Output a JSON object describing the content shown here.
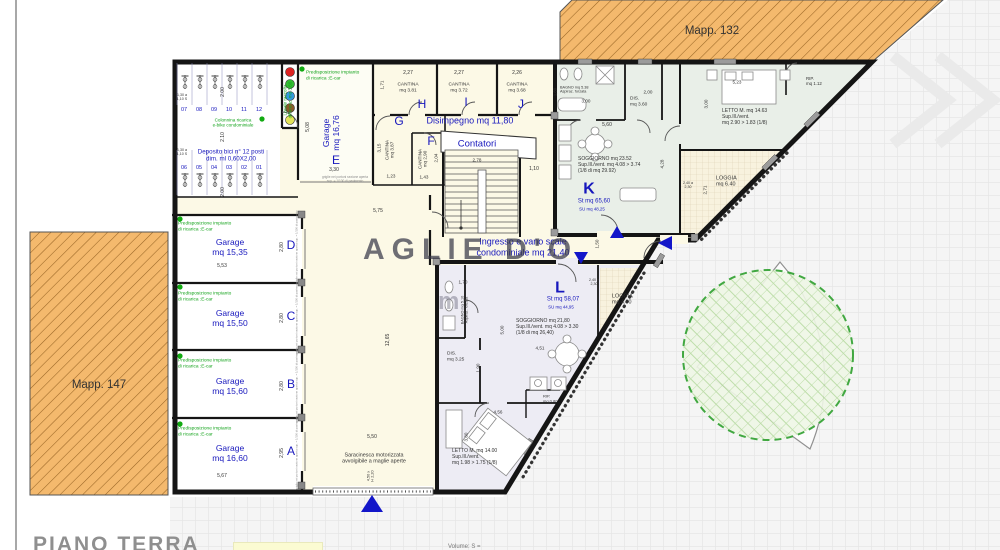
{
  "sheet": {
    "title": "PIANO TERRA",
    "legend_note": "Volume: S ="
  },
  "watermark": {
    "text": "AGLIE D'O",
    "text2": "m"
  },
  "palette": {
    "blue": "#1717bd",
    "green": "#14a31c",
    "dark": "#333333",
    "gray": "#8c8c8c",
    "orange": "#f4b96d",
    "tree_green": "#2ea02e",
    "wall": "#151515",
    "marker_blue": "#1316c9"
  },
  "labels": [
    {
      "n": "mapp-132-label",
      "t": "Mapp. 132",
      "x": 712,
      "y": 32,
      "s": 11.5,
      "c": "dark"
    },
    {
      "n": "mapp-147-label",
      "t": "Mapp. 147",
      "x": 99,
      "y": 386,
      "s": 11.5,
      "c": "dark"
    },
    {
      "n": "bike-slot-07",
      "t": "07",
      "x": 184,
      "y": 110,
      "s": 5.5,
      "c": "blue"
    },
    {
      "n": "bike-slot-08",
      "t": "08",
      "x": 199,
      "y": 110,
      "s": 5.5,
      "c": "blue"
    },
    {
      "n": "bike-slot-09",
      "t": "09",
      "x": 214,
      "y": 110,
      "s": 5.5,
      "c": "blue"
    },
    {
      "n": "bike-slot-10",
      "t": "10",
      "x": 229,
      "y": 110,
      "s": 5.5,
      "c": "blue"
    },
    {
      "n": "bike-slot-11",
      "t": "11",
      "x": 244,
      "y": 110,
      "s": 5.5,
      "c": "blue"
    },
    {
      "n": "bike-slot-12",
      "t": "12",
      "x": 259,
      "y": 110,
      "s": 5.5,
      "c": "blue"
    },
    {
      "n": "bike-slot-06",
      "t": "06",
      "x": 184,
      "y": 168,
      "s": 5.5,
      "c": "blue"
    },
    {
      "n": "bike-slot-05",
      "t": "05",
      "x": 199,
      "y": 168,
      "s": 5.5,
      "c": "blue"
    },
    {
      "n": "bike-slot-04",
      "t": "04",
      "x": 214,
      "y": 168,
      "s": 5.5,
      "c": "blue"
    },
    {
      "n": "bike-slot-03",
      "t": "03",
      "x": 229,
      "y": 168,
      "s": 5.5,
      "c": "blue"
    },
    {
      "n": "bike-slot-02",
      "t": "02",
      "x": 244,
      "y": 168,
      "s": 5.5,
      "c": "blue"
    },
    {
      "n": "bike-slot-01",
      "t": "01",
      "x": 259,
      "y": 168,
      "s": 5.5,
      "c": "blue"
    },
    {
      "t": "2.00",
      "x": 224,
      "y": 92,
      "r": -90,
      "s": 5,
      "c": "dark"
    },
    {
      "t": "2.10",
      "x": 224,
      "y": 137,
      "r": -90,
      "s": 5,
      "c": "dark"
    },
    {
      "t": "2.00",
      "x": 224,
      "y": 192,
      "r": -90,
      "s": 5,
      "c": "dark"
    },
    {
      "t": "1,30 a\n1,10 S",
      "x": 182,
      "y": 97,
      "s": 3.6,
      "c": "dark"
    },
    {
      "t": "1,30 a\n1,10 S",
      "x": 182,
      "y": 152,
      "s": 3.6,
      "c": "dark"
    },
    {
      "n": "colonnina-ricarica-label",
      "t": "Colonnina ricarica\ne-bike condominiale",
      "x": 233,
      "y": 123,
      "s": 4.6,
      "c": "green"
    },
    {
      "n": "deposito-bici-label",
      "t": "Deposito bici n° 12 posti\ndim. ml 0,60X2,00",
      "x": 231,
      "y": 156,
      "s": 6.2,
      "c": "blue"
    },
    {
      "n": "locale-raccolta-label",
      "t": "Locale raccolta\ndifferenz. mq 3,60",
      "x": 288,
      "y": 100,
      "r": -90,
      "s": 4.6,
      "c": "green"
    },
    {
      "n": "ecar-label-e",
      "t": "Predisposizione impianto\ndi ricarica :E-car",
      "x": 306,
      "y": 76,
      "s": 4.8,
      "c": "green",
      "a": "left"
    },
    {
      "n": "garage-e-label",
      "t": "Garage\nmq 16,76",
      "x": 331,
      "y": 133,
      "r": -90,
      "s": 8.5,
      "c": "blue"
    },
    {
      "n": "garage-e-letter",
      "t": "E",
      "x": 336,
      "y": 160,
      "s": 12,
      "c": "blue"
    },
    {
      "t": "5,08",
      "x": 309,
      "y": 127,
      "r": -90,
      "s": 5,
      "c": "dark"
    },
    {
      "t": "3,30",
      "x": 334,
      "y": 171,
      "s": 5,
      "c": "dark"
    },
    {
      "n": "griglie-note-e",
      "t": "griglie nei portoni sezione aperta\nsup. = 1/100 di pavimento",
      "x": 345,
      "y": 180,
      "s": 3.2,
      "c": "gray"
    },
    {
      "t": "2,27",
      "x": 408,
      "y": 74,
      "s": 5,
      "c": "dark"
    },
    {
      "n": "cantina-h-label",
      "t": "CANTINA\nmq 3.81",
      "x": 408,
      "y": 88,
      "s": 4.8,
      "c": "dark"
    },
    {
      "n": "cantina-h-letter",
      "t": "H",
      "x": 422,
      "y": 104,
      "s": 12,
      "c": "blue"
    },
    {
      "t": "1,71",
      "x": 382,
      "y": 85,
      "r": -90,
      "s": 4.6,
      "c": "dark"
    },
    {
      "t": "2,27",
      "x": 459,
      "y": 74,
      "s": 5,
      "c": "dark"
    },
    {
      "n": "cantina-i-label",
      "t": "CANTINA\nmq 3.72",
      "x": 459,
      "y": 88,
      "s": 4.8,
      "c": "dark"
    },
    {
      "n": "cantina-i-letter",
      "t": "I",
      "x": 466,
      "y": 102,
      "s": 12,
      "c": "blue"
    },
    {
      "t": "2,26",
      "x": 517,
      "y": 74,
      "s": 5,
      "c": "dark"
    },
    {
      "n": "cantina-j-label",
      "t": "CANTINA\nmq 3.68",
      "x": 517,
      "y": 88,
      "s": 4.8,
      "c": "dark"
    },
    {
      "n": "cantina-j-letter",
      "t": "J",
      "x": 521,
      "y": 104,
      "s": 12,
      "c": "blue"
    },
    {
      "n": "cantina-g-letter",
      "t": "G",
      "x": 399,
      "y": 121,
      "s": 12,
      "c": "blue"
    },
    {
      "n": "cantina-g-label",
      "t": "CANTINA\nmq 3.87",
      "x": 390,
      "y": 150,
      "r": -90,
      "s": 4.6,
      "c": "dark"
    },
    {
      "t": "3,15",
      "x": 379,
      "y": 148,
      "r": -90,
      "s": 4.6,
      "c": "dark"
    },
    {
      "t": "1,23",
      "x": 391,
      "y": 176,
      "s": 4.6,
      "c": "dark"
    },
    {
      "n": "cantina-f-letter",
      "t": "F",
      "x": 431,
      "y": 141,
      "s": 12,
      "c": "blue"
    },
    {
      "n": "cantina-f-label",
      "t": "CANTINA\nmq 2,90",
      "x": 423,
      "y": 159,
      "r": -90,
      "s": 4.6,
      "c": "dark"
    },
    {
      "t": "2,04",
      "x": 436,
      "y": 158,
      "r": -90,
      "s": 4.6,
      "c": "dark"
    },
    {
      "t": "1,43",
      "x": 424,
      "y": 177,
      "s": 4.6,
      "c": "dark"
    },
    {
      "n": "disimpegno-label",
      "t": "Disimpegno mq 11,80",
      "x": 470,
      "y": 121,
      "s": 9,
      "c": "blue"
    },
    {
      "n": "contatori-label",
      "t": "Contatori",
      "x": 477,
      "y": 144,
      "s": 9.5,
      "c": "blue"
    },
    {
      "t": "2,78",
      "x": 477,
      "y": 160,
      "s": 4.6,
      "c": "dark"
    },
    {
      "t": "1,10",
      "x": 534,
      "y": 170,
      "s": 5,
      "c": "dark"
    },
    {
      "t": "5,75",
      "x": 378,
      "y": 212,
      "s": 5,
      "c": "dark"
    },
    {
      "t": "12,65",
      "x": 389,
      "y": 340,
      "r": -90,
      "s": 5,
      "c": "dark"
    },
    {
      "n": "ingresso-label",
      "t": "Ingresso e vano scale\ncondominiale mq 21,40",
      "x": 523,
      "y": 247,
      "s": 9,
      "c": "blue"
    },
    {
      "t": "1,50",
      "x": 597,
      "y": 244,
      "r": -90,
      "s": 4.6,
      "c": "dark"
    },
    {
      "n": "bagno-k-label",
      "t": "BAGNO mq 5.38\nAspiraz. forzata",
      "x": 560,
      "y": 90,
      "s": 3.8,
      "c": "dark",
      "a": "left"
    },
    {
      "t": "3,00",
      "x": 586,
      "y": 101,
      "s": 4.6,
      "c": "dark"
    },
    {
      "t": "1,80",
      "x": 556,
      "y": 92,
      "r": -90,
      "s": 4.2,
      "c": "dark"
    },
    {
      "n": "dis-k-label",
      "t": "DIS.\nmq 3.60",
      "x": 630,
      "y": 102,
      "s": 4.8,
      "c": "dark",
      "a": "left"
    },
    {
      "t": "2,00",
      "x": 648,
      "y": 92,
      "s": 4.6,
      "c": "dark"
    },
    {
      "t": "5,60",
      "x": 607,
      "y": 126,
      "s": 5,
      "c": "dark"
    },
    {
      "n": "soggiorno-k-label",
      "t": "SOGGIORNO mq 23.52\nSup.Ill./vent. mq 4.08 > 3.74\n(1/8 di mq 29.92)",
      "x": 578,
      "y": 166,
      "s": 5,
      "c": "dark",
      "a": "left"
    },
    {
      "n": "unit-k-letter",
      "t": "K",
      "x": 589,
      "y": 190,
      "s": 16,
      "c": "blue",
      "b": 1
    },
    {
      "n": "unit-k-st",
      "t": "St mq 65,60",
      "x": 594,
      "y": 202,
      "s": 6,
      "c": "blue"
    },
    {
      "n": "unit-k-su",
      "t": "SU mq 48,25",
      "x": 592,
      "y": 209,
      "s": 4.4,
      "c": "blue"
    },
    {
      "t": "4,28",
      "x": 662,
      "y": 164,
      "r": -90,
      "s": 4.6,
      "c": "dark"
    },
    {
      "t": "3,00",
      "x": 706,
      "y": 104,
      "r": -90,
      "s": 4.6,
      "c": "dark"
    },
    {
      "t": "5,23",
      "x": 737,
      "y": 82,
      "s": 4.6,
      "c": "dark"
    },
    {
      "n": "letto-k-label",
      "t": "LETTO M. mq 14.63\nSup.Ill./vent.\nmq 2.90 > 1.83 (1/8)",
      "x": 722,
      "y": 118,
      "s": 5,
      "c": "dark",
      "a": "left"
    },
    {
      "n": "rip-k-label",
      "t": "RIP.\nmq 1.12",
      "x": 806,
      "y": 81,
      "s": 4.4,
      "c": "dark",
      "a": "left"
    },
    {
      "n": "loggia-k-label",
      "t": "LOGGIA\nmq 6.40",
      "x": 716,
      "y": 182,
      "s": 5.4,
      "c": "dark",
      "a": "left"
    },
    {
      "t": "2,71",
      "x": 705,
      "y": 190,
      "r": -90,
      "s": 4.6,
      "c": "dark"
    },
    {
      "t": "2,40 a\n2,30",
      "x": 688,
      "y": 185,
      "s": 3.6,
      "c": "dark"
    },
    {
      "n": "unit-l-letter",
      "t": "L",
      "x": 560,
      "y": 289,
      "s": 16,
      "c": "blue",
      "b": 1
    },
    {
      "n": "unit-l-st",
      "t": "St mq 58,07",
      "x": 563,
      "y": 300,
      "s": 6,
      "c": "blue"
    },
    {
      "n": "unit-l-su",
      "t": "SU mq 44,95",
      "x": 561,
      "y": 307,
      "s": 4.4,
      "c": "blue"
    },
    {
      "n": "soggiorno-l-label",
      "t": "SOGGIORNO mq 21,80\nSup.Ill./vent. mq 4.08 > 3.30\n(1/8 di mq 26,40)",
      "x": 516,
      "y": 328,
      "s": 5,
      "c": "dark",
      "a": "left"
    },
    {
      "t": "4,51",
      "x": 540,
      "y": 348,
      "s": 4.6,
      "c": "dark"
    },
    {
      "t": "5,00",
      "x": 502,
      "y": 330,
      "r": -90,
      "s": 4.6,
      "c": "dark"
    },
    {
      "t": "1,70",
      "x": 463,
      "y": 282,
      "s": 4.6,
      "c": "dark"
    },
    {
      "n": "bagno-l-label",
      "t": "BAGNO mq 5.10\nAspiraz. forzata",
      "x": 465,
      "y": 310,
      "r": -90,
      "s": 3.8,
      "c": "dark"
    },
    {
      "n": "dis-l-label",
      "t": "DIS.\nmq 3.25",
      "x": 447,
      "y": 357,
      "s": 4.8,
      "c": "dark",
      "a": "left"
    },
    {
      "t": "1,90",
      "x": 478,
      "y": 368,
      "r": -90,
      "s": 4.6,
      "c": "dark"
    },
    {
      "n": "loggia-l-label",
      "t": "LOGGIA\nmq 4.60",
      "x": 612,
      "y": 300,
      "s": 5.4,
      "c": "dark",
      "a": "left"
    },
    {
      "t": "2,40 a\n2,30",
      "x": 594,
      "y": 282,
      "s": 3.6,
      "c": "dark"
    },
    {
      "n": "rip-l-label",
      "t": "RIP.\nmq 0.80",
      "x": 543,
      "y": 399,
      "s": 4,
      "c": "dark",
      "a": "left"
    },
    {
      "n": "letto-l-label",
      "t": "LETTO M. mq 14.00\nSup.Ill./vent.\nmq 1.98 > 1.75 (1/8)",
      "x": 452,
      "y": 458,
      "s": 5,
      "c": "dark",
      "a": "left"
    },
    {
      "t": "4,56",
      "x": 498,
      "y": 412,
      "s": 4.6,
      "c": "dark"
    },
    {
      "t": "3,80",
      "x": 466,
      "y": 437,
      "r": -90,
      "s": 4.6,
      "c": "dark"
    },
    {
      "n": "ecar-label-d",
      "t": "Predisposizione impianto\ndi ricarica :E-car",
      "x": 178,
      "y": 227,
      "s": 4.8,
      "c": "green",
      "a": "left"
    },
    {
      "n": "garage-d-label",
      "t": "Garage\nmq 15,35",
      "x": 230,
      "y": 247,
      "s": 8.5,
      "c": "blue"
    },
    {
      "t": "5,53",
      "x": 222,
      "y": 267,
      "s": 5,
      "c": "dark"
    },
    {
      "t": "2,80",
      "x": 283,
      "y": 247,
      "r": -90,
      "s": 5,
      "c": "dark"
    },
    {
      "n": "garage-d-letter",
      "t": "D",
      "x": 291,
      "y": 245,
      "s": 12,
      "c": "blue"
    },
    {
      "n": "griglie-note-d",
      "t": "griglie nei portoni sezione aperta sup. = 1/100 di pavimento",
      "x": 297,
      "y": 247,
      "r": -90,
      "s": 2.8,
      "c": "gray"
    },
    {
      "n": "ecar-label-c",
      "t": "Predisposizione impianto\ndi ricarica :E-car",
      "x": 178,
      "y": 297,
      "s": 4.8,
      "c": "green",
      "a": "left"
    },
    {
      "n": "garage-c-label",
      "t": "Garage\nmq 15,50",
      "x": 230,
      "y": 318,
      "s": 8.5,
      "c": "blue"
    },
    {
      "t": "2,80",
      "x": 283,
      "y": 318,
      "r": -90,
      "s": 5,
      "c": "dark"
    },
    {
      "n": "garage-c-letter",
      "t": "C",
      "x": 291,
      "y": 316,
      "s": 12,
      "c": "blue"
    },
    {
      "n": "griglie-note-c",
      "t": "griglie nei portoni sezione aperta sup. = 1/100 di pavimento",
      "x": 297,
      "y": 318,
      "r": -90,
      "s": 2.8,
      "c": "gray"
    },
    {
      "n": "ecar-label-b",
      "t": "Predisposizione impianto\ndi ricarica :E-car",
      "x": 178,
      "y": 364,
      "s": 4.8,
      "c": "green",
      "a": "left"
    },
    {
      "n": "garage-b-label",
      "t": "Garage\nmq 15,60",
      "x": 230,
      "y": 386,
      "s": 8.5,
      "c": "blue"
    },
    {
      "t": "2,80",
      "x": 283,
      "y": 386,
      "r": -90,
      "s": 5,
      "c": "dark"
    },
    {
      "n": "garage-b-letter",
      "t": "B",
      "x": 291,
      "y": 384,
      "s": 12,
      "c": "blue"
    },
    {
      "n": "griglie-note-b",
      "t": "griglie nei portoni sezione aperta sup. = 1/100 di pavimento",
      "x": 297,
      "y": 386,
      "r": -90,
      "s": 2.8,
      "c": "gray"
    },
    {
      "n": "ecar-label-a",
      "t": "Predisposizione impianto\ndi ricarica :E-car",
      "x": 178,
      "y": 432,
      "s": 4.8,
      "c": "green",
      "a": "left"
    },
    {
      "n": "garage-a-label",
      "t": "Garage\nmq 16,60",
      "x": 230,
      "y": 453,
      "s": 8.5,
      "c": "blue"
    },
    {
      "t": "5,67",
      "x": 222,
      "y": 477,
      "s": 5,
      "c": "dark"
    },
    {
      "t": "2,95",
      "x": 283,
      "y": 453,
      "r": -90,
      "s": 5,
      "c": "dark"
    },
    {
      "n": "garage-a-letter",
      "t": "A",
      "x": 291,
      "y": 451,
      "s": 12,
      "c": "blue"
    },
    {
      "n": "griglie-note-a",
      "t": "griglie nei portoni sezione aperta sup. = 1/100 di pavimento",
      "x": 297,
      "y": 453,
      "r": -90,
      "s": 2.8,
      "c": "gray"
    },
    {
      "t": "5,50",
      "x": 372,
      "y": 438,
      "s": 5,
      "c": "dark"
    },
    {
      "n": "saracinesca-label",
      "t": "Saracinesca motorizzata\navvolgibile a maglie aperte",
      "x": 374,
      "y": 459,
      "s": 5.4,
      "c": "dark"
    },
    {
      "t": "4,50 x\nH 2,20",
      "x": 371,
      "y": 476,
      "r": -90,
      "s": 3.8,
      "c": "dark"
    }
  ]
}
